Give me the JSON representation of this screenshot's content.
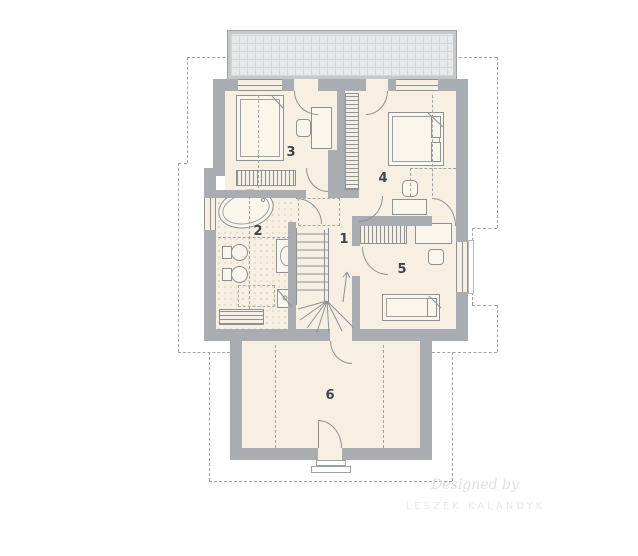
{
  "rooms": {
    "r1": "1",
    "r2": "2",
    "r3": "3",
    "r4": "4",
    "r5": "5",
    "r6": "6"
  },
  "watermark": {
    "line1": "Designed by",
    "line2": "LESZEK KALANDYK"
  },
  "colors": {
    "wall": "#a9adb1",
    "floor": "#f6efe2",
    "line": "#8d9296",
    "balcony": "#e7e8ea",
    "dashed_outline": "#9fa3a7",
    "label": "#3f4449",
    "watermark": "#e2dfda"
  }
}
